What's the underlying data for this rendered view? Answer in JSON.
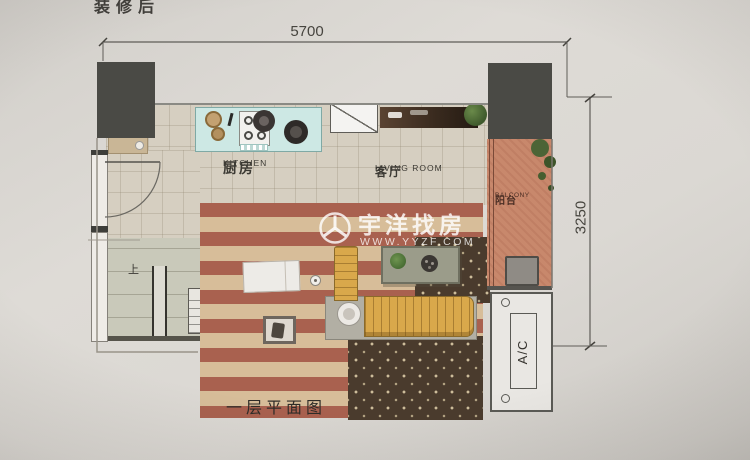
{
  "meta": {
    "title": "装修后"
  },
  "dimensions": {
    "top": "5700",
    "right": "3250"
  },
  "rooms": {
    "kitchen": {
      "zh": "厨房",
      "en": "KITCHEN"
    },
    "living": {
      "zh": "客厅",
      "en": "LIVING ROOM"
    },
    "balcony": {
      "zh": "阳台",
      "en": "BALCONY"
    }
  },
  "labels": {
    "stairs_up": "上",
    "ac": "A/C",
    "caption": "一层平面图"
  },
  "watermark": {
    "brand": "宇洋找房",
    "site": "WWW.YYZF.COM"
  },
  "icons": [
    "watermark-logo-icon",
    "plant-icon",
    "stove-icon",
    "wok-icon",
    "sink-icon",
    "plate-icon",
    "washing-machine-icon",
    "tv-icon",
    "lamp-icon"
  ],
  "colors": {
    "paper": "#d8d5d0",
    "structure_column": "#4a4a45",
    "kitchen_counter": "#cde8e4",
    "rug_red": "#a9614f",
    "rug_tan": "#d7bd99",
    "star_rug": "#4a3b2d",
    "balcony_floor": "#c8886c",
    "sofa_wood": "#d9a84b",
    "watermark": "#ffffff"
  }
}
